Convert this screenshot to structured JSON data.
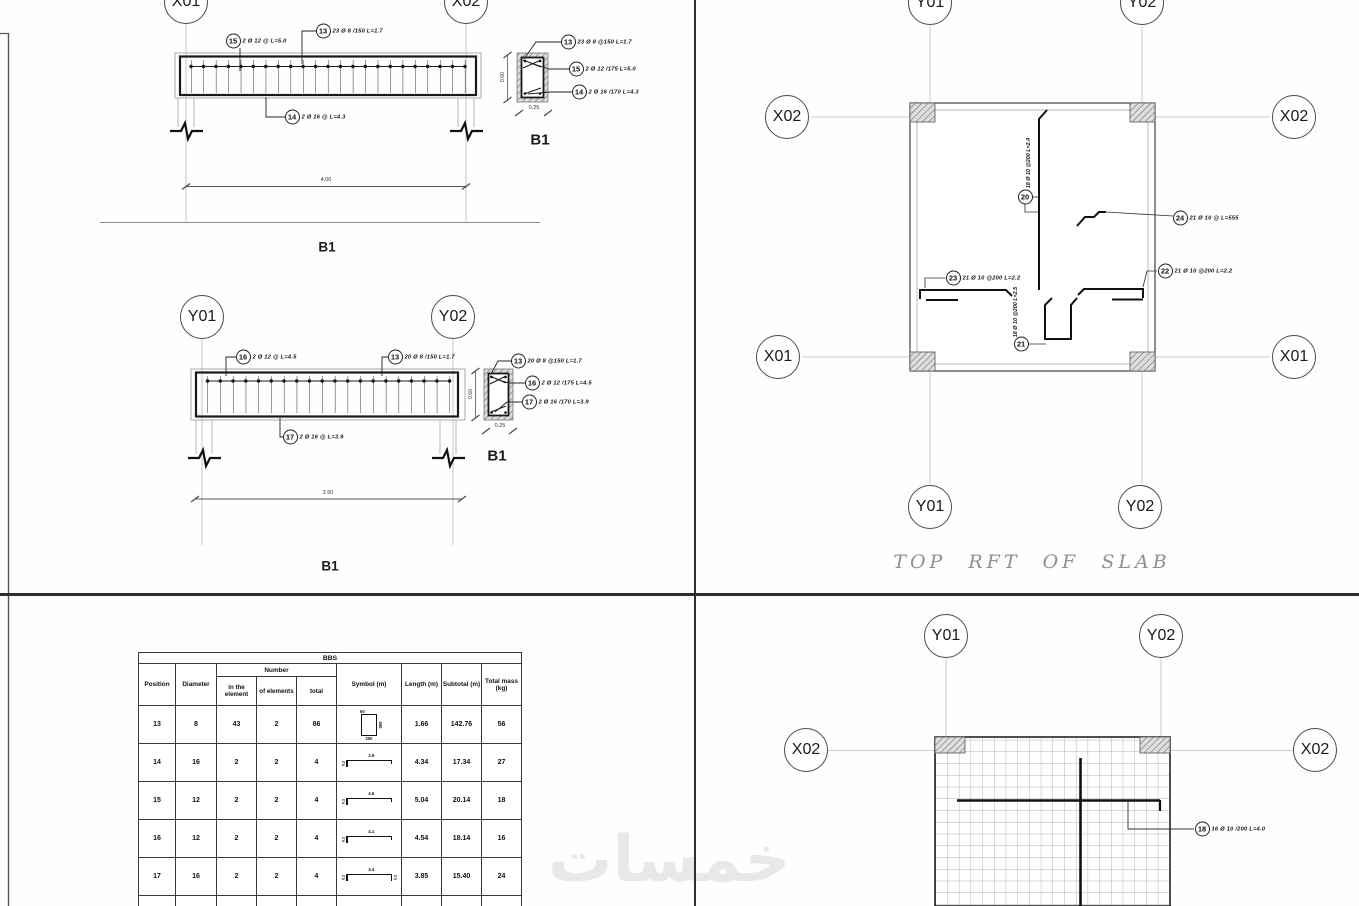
{
  "watermark": {
    "text": "خمسات"
  },
  "beam_top": {
    "grid_left": "X01",
    "grid_right": "X02",
    "stirrup_callout": {
      "num": "13",
      "text": "23 Ø 8 /150 L=1.7"
    },
    "top_bar_callout": {
      "num": "15",
      "text": "2 Ø 12 @ L=5.0"
    },
    "bottom_bar_callout": {
      "num": "14",
      "text": "2 Ø 16 @ L=4.3"
    },
    "span_dim": "4.00",
    "label": "B1",
    "section": {
      "stirrup_callout": {
        "num": "13",
        "text": "23 Ø 8 @150 L=1.7"
      },
      "top_bar_callout": {
        "num": "15",
        "text": "2 Ø 12 /175 L=5.0"
      },
      "bottom_bar_callout": {
        "num": "14",
        "text": "2 Ø 16 /170 L=4.3"
      },
      "height_dim": "0.60",
      "width_dim": "0.25",
      "label": "B1"
    }
  },
  "beam_mid": {
    "grid_left": "Y01",
    "grid_right": "Y02",
    "stirrup_callout": {
      "num": "13",
      "text": "20 Ø 8 /150 L=1.7"
    },
    "top_bar_callout": {
      "num": "16",
      "text": "2 Ø 12 @ L=4.5"
    },
    "bottom_bar_callout": {
      "num": "17",
      "text": "2 Ø 16 @ L=3.9"
    },
    "span_dim": "3.50",
    "label": "B1",
    "section": {
      "stirrup_callout": {
        "num": "13",
        "text": "20 Ø 8 @150 L=1.7"
      },
      "top_bar_callout": {
        "num": "16",
        "text": "2 Ø 12 /175 L=4.5"
      },
      "bottom_bar_callout": {
        "num": "17",
        "text": "2 Ø 16 /170 L=3.9"
      },
      "height_dim": "0.60",
      "width_dim": "0.25",
      "label": "B1"
    }
  },
  "bbs": {
    "title": "BBS",
    "headers": {
      "position": "Position",
      "diameter": "Diameter",
      "number": "Number",
      "in_element": "in the element",
      "of_elements": "of elements",
      "total": "total",
      "symbol": "Symbol (m)",
      "length": "Length (m)",
      "subtotal": "Subtotal (m)",
      "total_mass": "Total mass (kg)"
    },
    "rows": [
      {
        "position": "13",
        "diameter": "8",
        "in_element": "43",
        "of_elements": "2",
        "total": "86",
        "symbol": {
          "type": "stirrup",
          "hook": "60",
          "height": "550",
          "width": "200"
        },
        "length": "1.66",
        "subtotal": "142.76",
        "total_mass": "56"
      },
      {
        "position": "14",
        "diameter": "16",
        "in_element": "2",
        "of_elements": "2",
        "total": "4",
        "symbol": {
          "type": "hook-left",
          "main": "3.9",
          "hook": "0.2"
        },
        "length": "4.34",
        "subtotal": "17.34",
        "total_mass": "27"
      },
      {
        "position": "15",
        "diameter": "12",
        "in_element": "2",
        "of_elements": "2",
        "total": "4",
        "symbol": {
          "type": "hook-left",
          "main": "4.6",
          "hook": "0.2"
        },
        "length": "5.04",
        "subtotal": "20.14",
        "total_mass": "18"
      },
      {
        "position": "16",
        "diameter": "12",
        "in_element": "2",
        "of_elements": "2",
        "total": "4",
        "symbol": {
          "type": "hook-left",
          "main": "4.1",
          "hook": "0.2"
        },
        "length": "4.54",
        "subtotal": "18.14",
        "total_mass": "16"
      },
      {
        "position": "17",
        "diameter": "16",
        "in_element": "2",
        "of_elements": "2",
        "total": "4",
        "symbol": {
          "type": "hook-both",
          "main": "3.4",
          "hook": "0.2",
          "hook2": "0.2"
        },
        "length": "3.85",
        "subtotal": "15.40",
        "total_mass": "24"
      },
      {
        "position": "18",
        "diameter": "10",
        "in_element": "16",
        "of_elements": "1",
        "total": "16",
        "symbol": {
          "type": "hook-left",
          "main": "4.0",
          "hook": "0.2"
        },
        "length": "4.08",
        "subtotal": "65.28",
        "total_mass": "40"
      }
    ]
  },
  "slab_top": {
    "title": "TOP RFT OF SLAB",
    "grid_top_left": "Y01",
    "grid_top_right": "Y02",
    "grid_left_upper": "X02",
    "grid_right_upper": "X02",
    "grid_left_lower": "X01",
    "grid_right_lower": "X01",
    "grid_bottom_left": "Y01",
    "grid_bottom_right": "Y02",
    "callout_top_vertical": {
      "num": "20",
      "text": "18 Ø 10 @200 L=2.4"
    },
    "callout_right_upper": {
      "num": "24",
      "text": "21 Ø 10 @ L=555"
    },
    "callout_left": {
      "num": "23",
      "text": "21 Ø 10 @200 L=2.2"
    },
    "callout_right": {
      "num": "22",
      "text": "21 Ø 10 @200 L=2.2"
    },
    "callout_bottom_vertical": {
      "num": "21",
      "text": "18 Ø 10 @200 L=2.5"
    }
  },
  "slab_bottom": {
    "grid_top_left": "Y01",
    "grid_top_right": "Y02",
    "grid_left": "X02",
    "grid_right": "X02",
    "callout": {
      "num": "18",
      "text": "16 Ø 10 /200 L=4.0"
    }
  }
}
